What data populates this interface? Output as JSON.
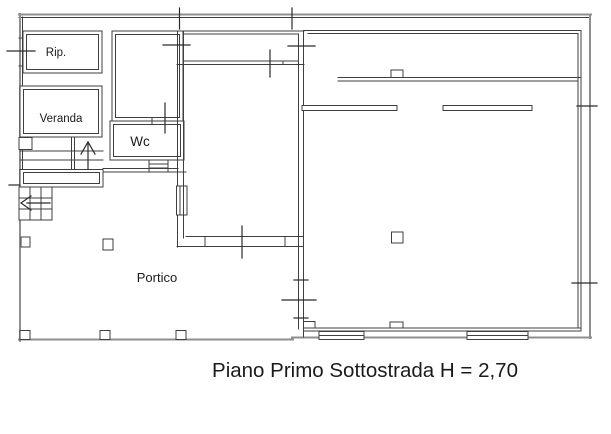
{
  "plan": {
    "labels": {
      "rip": "Rip.",
      "veranda": "Veranda",
      "wc": "Wc",
      "portico": "Portico"
    },
    "caption": "Piano Primo Sottostrada H = 2,70"
  },
  "colors": {
    "wall_dark": "#3f3f3f",
    "wall_gray": "#8f8f8f",
    "marker": "#2a2a2a",
    "text": "#1a1a1a",
    "background": "#ffffff"
  }
}
